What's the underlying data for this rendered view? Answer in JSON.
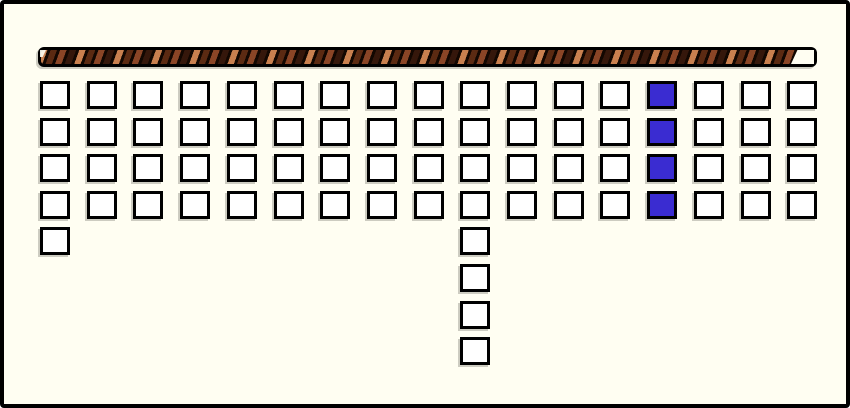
{
  "window": {
    "background_color": "#fffef2",
    "border_color": "#000000"
  },
  "timer_bar": {
    "description": "diagonal-striped timer/progress bar, nearly full",
    "fill_fraction": 0.97,
    "track_color": "#000000",
    "stripe_colors": {
      "light": "#c9804f",
      "mid": "#8a4526",
      "dark": "#5b2a12",
      "darkest": "#35170b"
    },
    "remaining_color": "#fffef2"
  },
  "board": {
    "columns": 17,
    "base_rows": 4,
    "column_heights": [
      5,
      4,
      4,
      4,
      4,
      4,
      4,
      4,
      4,
      8,
      4,
      4,
      4,
      4,
      4,
      4,
      4
    ],
    "highlighted_cells": [
      {
        "col": 14,
        "row": 1
      },
      {
        "col": 14,
        "row": 2
      },
      {
        "col": 14,
        "row": 3
      },
      {
        "col": 14,
        "row": 4
      }
    ],
    "colors": {
      "cell_fill": "#ffffff",
      "cell_border": "#000000",
      "cell_selected": "#3a2cd1"
    }
  }
}
